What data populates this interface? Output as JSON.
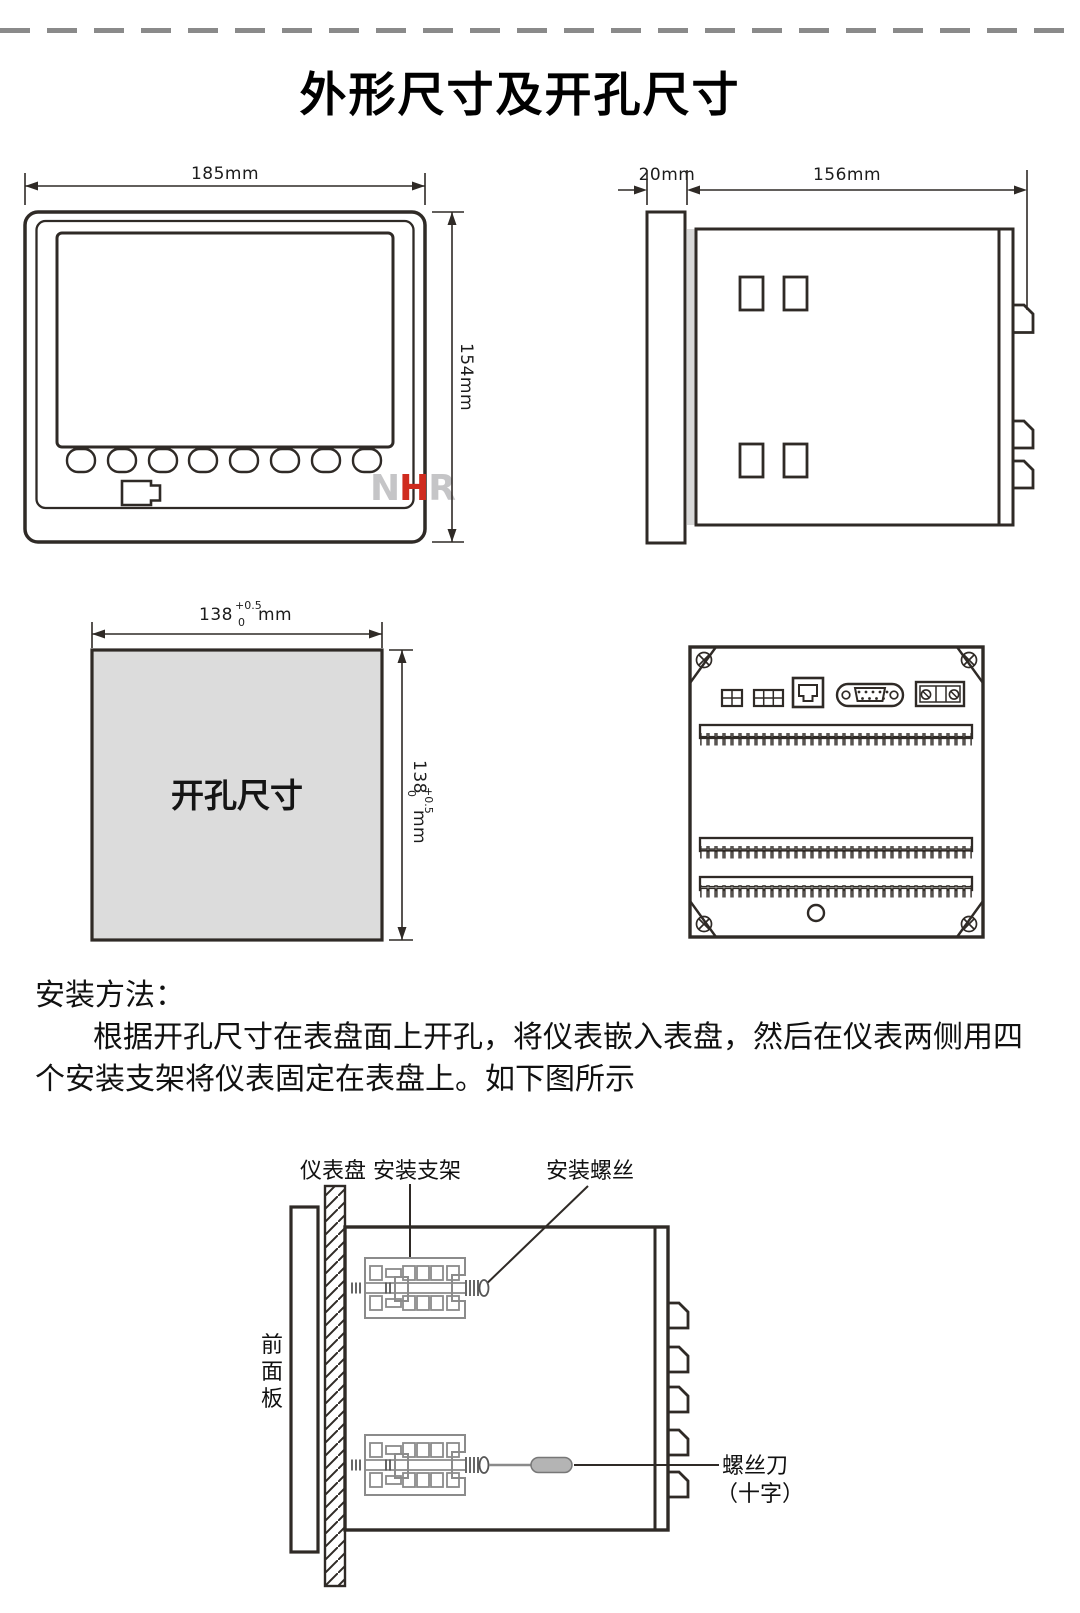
{
  "page": {
    "title": "外形尺寸及开孔尺寸"
  },
  "front_view": {
    "width_label": "185mm",
    "height_label": "154mm",
    "logo": {
      "n": "N",
      "h": "H",
      "r": "R"
    }
  },
  "side_view": {
    "bezel_label": "20mm",
    "depth_label": "156mm"
  },
  "cutout_view": {
    "label": "开孔尺寸",
    "value": "138",
    "tol_upper": "+0.5",
    "tol_lower": "0",
    "unit": "mm"
  },
  "instructions": {
    "heading": "安装方法：",
    "line1": "根据开孔尺寸在表盘面上开孔，将仪表嵌入表盘，然后在仪表两侧用四",
    "line2": "个安装支架将仪表固定在表盘上。如下图所示"
  },
  "install_diagram": {
    "panel_label": "仪表盘",
    "bracket_label": "安装支架",
    "screw_label": "安装螺丝",
    "front_panel_label": [
      "前",
      "面",
      "板"
    ],
    "screwdriver_label": "螺丝刀",
    "screwdriver_type_label": "（十字）"
  },
  "colors": {
    "line": "#2f2a26",
    "logo_red": "#cf2b1e",
    "logo_gray": "#c5c5c7",
    "cutout_fill": "#dcdcdc",
    "bracket_gray": "#8b8b8b",
    "dash_gray": "#8a8a8a"
  }
}
